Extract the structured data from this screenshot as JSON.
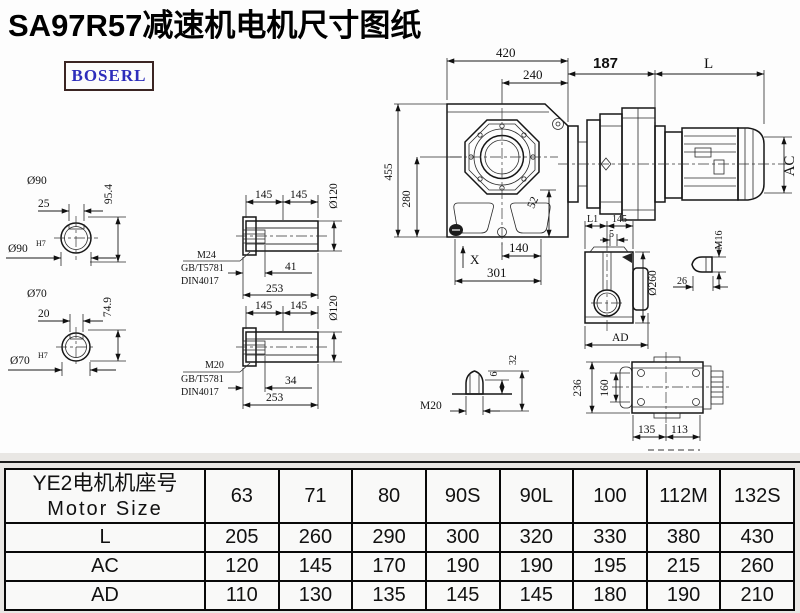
{
  "title": "SA97R57减速机电机尺寸图纸",
  "logo": "BOSERL",
  "drawing": {
    "labels": {
      "d90": "Ø90",
      "d70": "Ø70",
      "h7": "H7",
      "k25": "25",
      "k20": "20",
      "v95": "95.4",
      "v74": "74.9",
      "v145": "145",
      "v253": "253",
      "v41": "41",
      "v34": "34",
      "d120": "Ø120",
      "m24": "M24",
      "m20": "M20",
      "gbt": "GB/T5781",
      "din": "DIN4017",
      "v420": "420",
      "v240": "240",
      "v455": "455",
      "v280": "280",
      "v52": "52",
      "v140": "140",
      "v301": "301",
      "x": "X",
      "v187": "187",
      "L": "L",
      "ac": "AC",
      "l1": "L1",
      "v5": "5",
      "d260": "Ø260",
      "ad": "AD",
      "m16": "M16",
      "v26": "26",
      "v6": "6",
      "v32": "32",
      "v236": "236",
      "v160": "160",
      "v135": "135",
      "v113": "113"
    }
  },
  "table": {
    "header_cn": "YE2电机机座号",
    "header_en": "Motor Size",
    "columns": [
      "63",
      "71",
      "80",
      "90S",
      "90L",
      "100",
      "112M",
      "132S"
    ],
    "rows": [
      {
        "label": "L",
        "values": [
          "205",
          "260",
          "290",
          "300",
          "320",
          "330",
          "380",
          "430"
        ]
      },
      {
        "label": "AC",
        "values": [
          "120",
          "145",
          "170",
          "190",
          "190",
          "195",
          "215",
          "260"
        ]
      },
      {
        "label": "AD",
        "values": [
          "110",
          "130",
          "135",
          "145",
          "145",
          "180",
          "190",
          "210"
        ]
      }
    ]
  }
}
